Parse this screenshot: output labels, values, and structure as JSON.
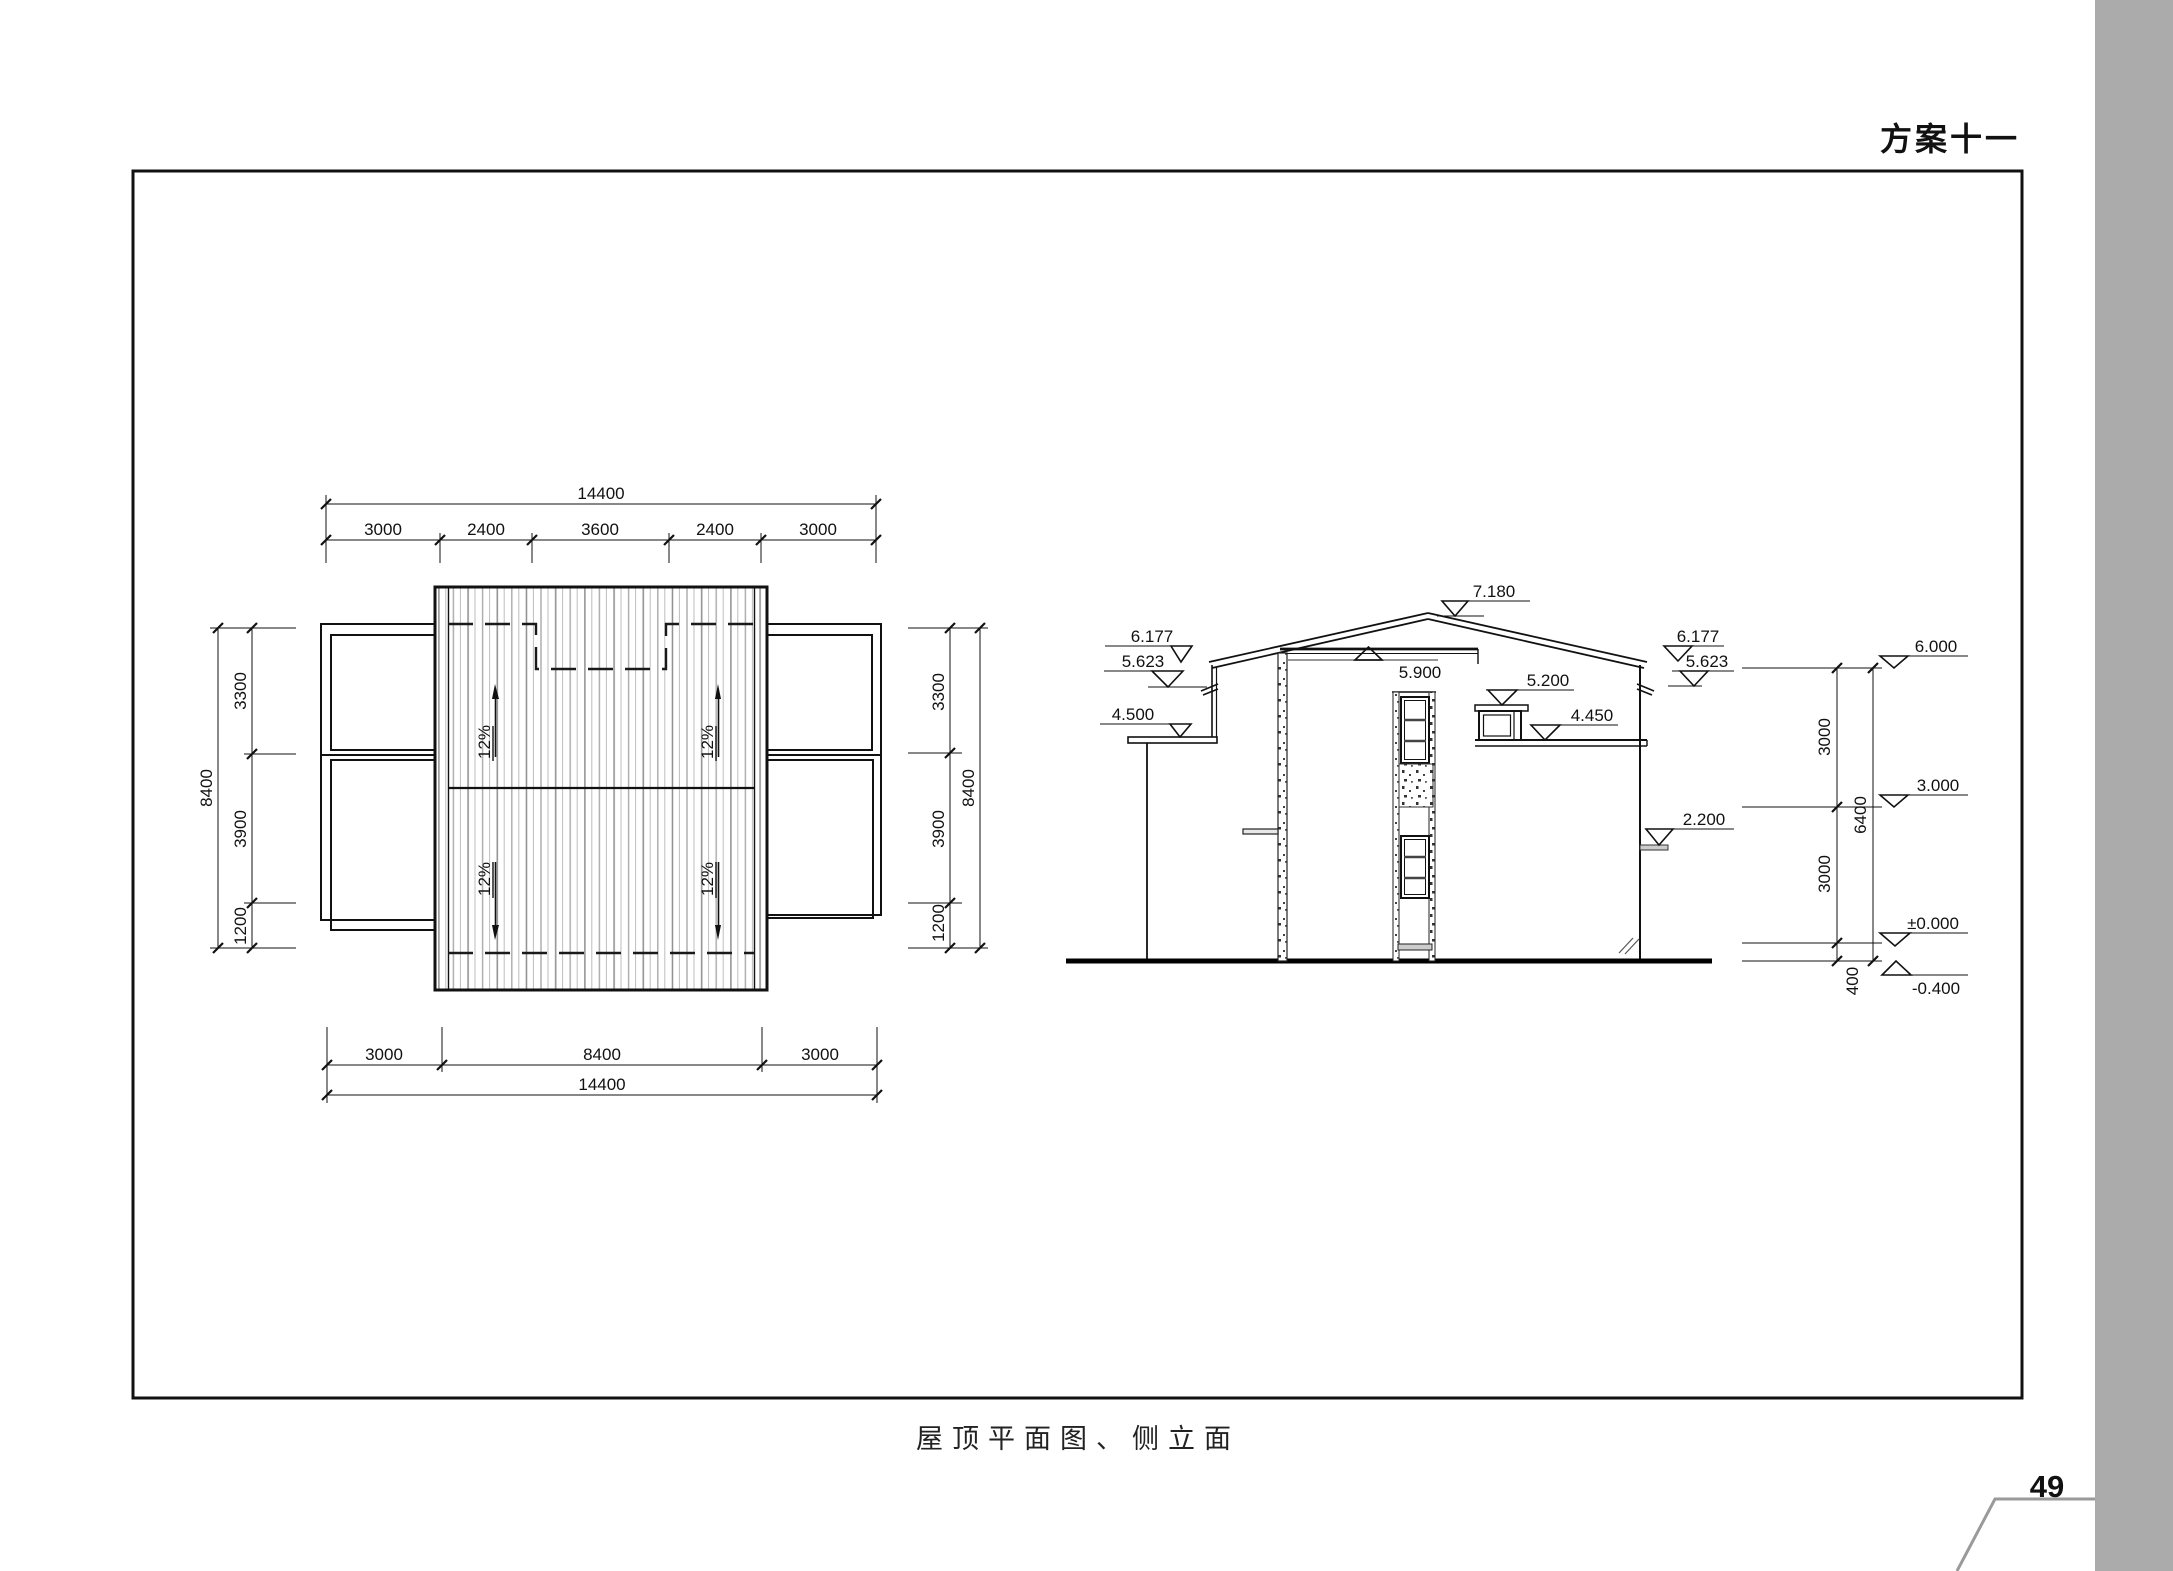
{
  "page": {
    "scheme_title": "方案十一",
    "caption": "屋顶平面图、侧立面",
    "page_number": "49"
  },
  "roof_plan": {
    "dim_top_total": "14400",
    "dim_top_segments": [
      "3000",
      "2400",
      "3600",
      "2400",
      "3000"
    ],
    "dim_bottom_segments": [
      "3000",
      "8400",
      "3000"
    ],
    "dim_bottom_total": "14400",
    "dim_side_segments": [
      "3300",
      "3900",
      "1200"
    ],
    "dim_side_total": "8400",
    "slope_label": "12%"
  },
  "elevation": {
    "level_ridge": "7.180",
    "levels_left": [
      "6.177",
      "5.623",
      "4.500"
    ],
    "level_parapet": "5.900",
    "levels_mid": [
      "5.200",
      "4.450"
    ],
    "levels_right": [
      "6.177",
      "5.623",
      "2.200"
    ],
    "levels_datum": [
      "6.000",
      "3.000",
      "±0.000",
      "-0.400"
    ],
    "dim_segments": [
      "3000",
      "3000",
      "400"
    ],
    "dim_total": "6400"
  }
}
